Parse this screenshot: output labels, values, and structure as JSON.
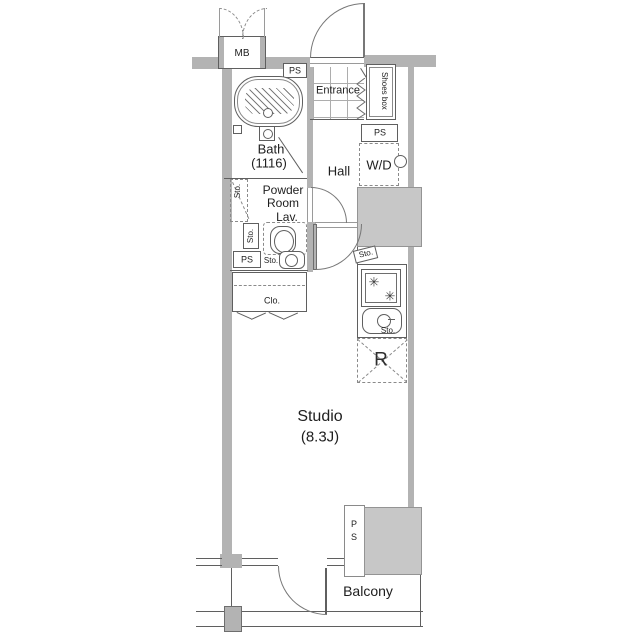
{
  "palette": {
    "wall": "#b3b3b3",
    "shaft": "#c7c7c7",
    "line": "#5f5f5f",
    "text": "#1e1e1e",
    "bg": "#ffffff"
  },
  "labels": {
    "mb": "MB",
    "ps_top": "PS",
    "entrance": "Entrance",
    "shoes_box": "Shoes box",
    "ps_laundry": "PS",
    "wd": "W/D",
    "bath_name": "Bath",
    "bath_size": "(1116)",
    "hall": "Hall",
    "powder_1": "Powder",
    "powder_2": "Room",
    "powder_3": "Lav.",
    "sto_tall": "Sto.",
    "sto_mid": "Sto.",
    "ps_left": "PS",
    "sto_basin": "Sto.",
    "clo": "Clo.",
    "sto_kitchen_top": "Sto.",
    "sto_kitchen_sink": "Sto.",
    "fridge": "R",
    "studio_name": "Studio",
    "studio_size": "(8.3J)",
    "ps_shaft": "PS",
    "balcony": "Balcony"
  },
  "icons": {
    "burner": "✳"
  }
}
